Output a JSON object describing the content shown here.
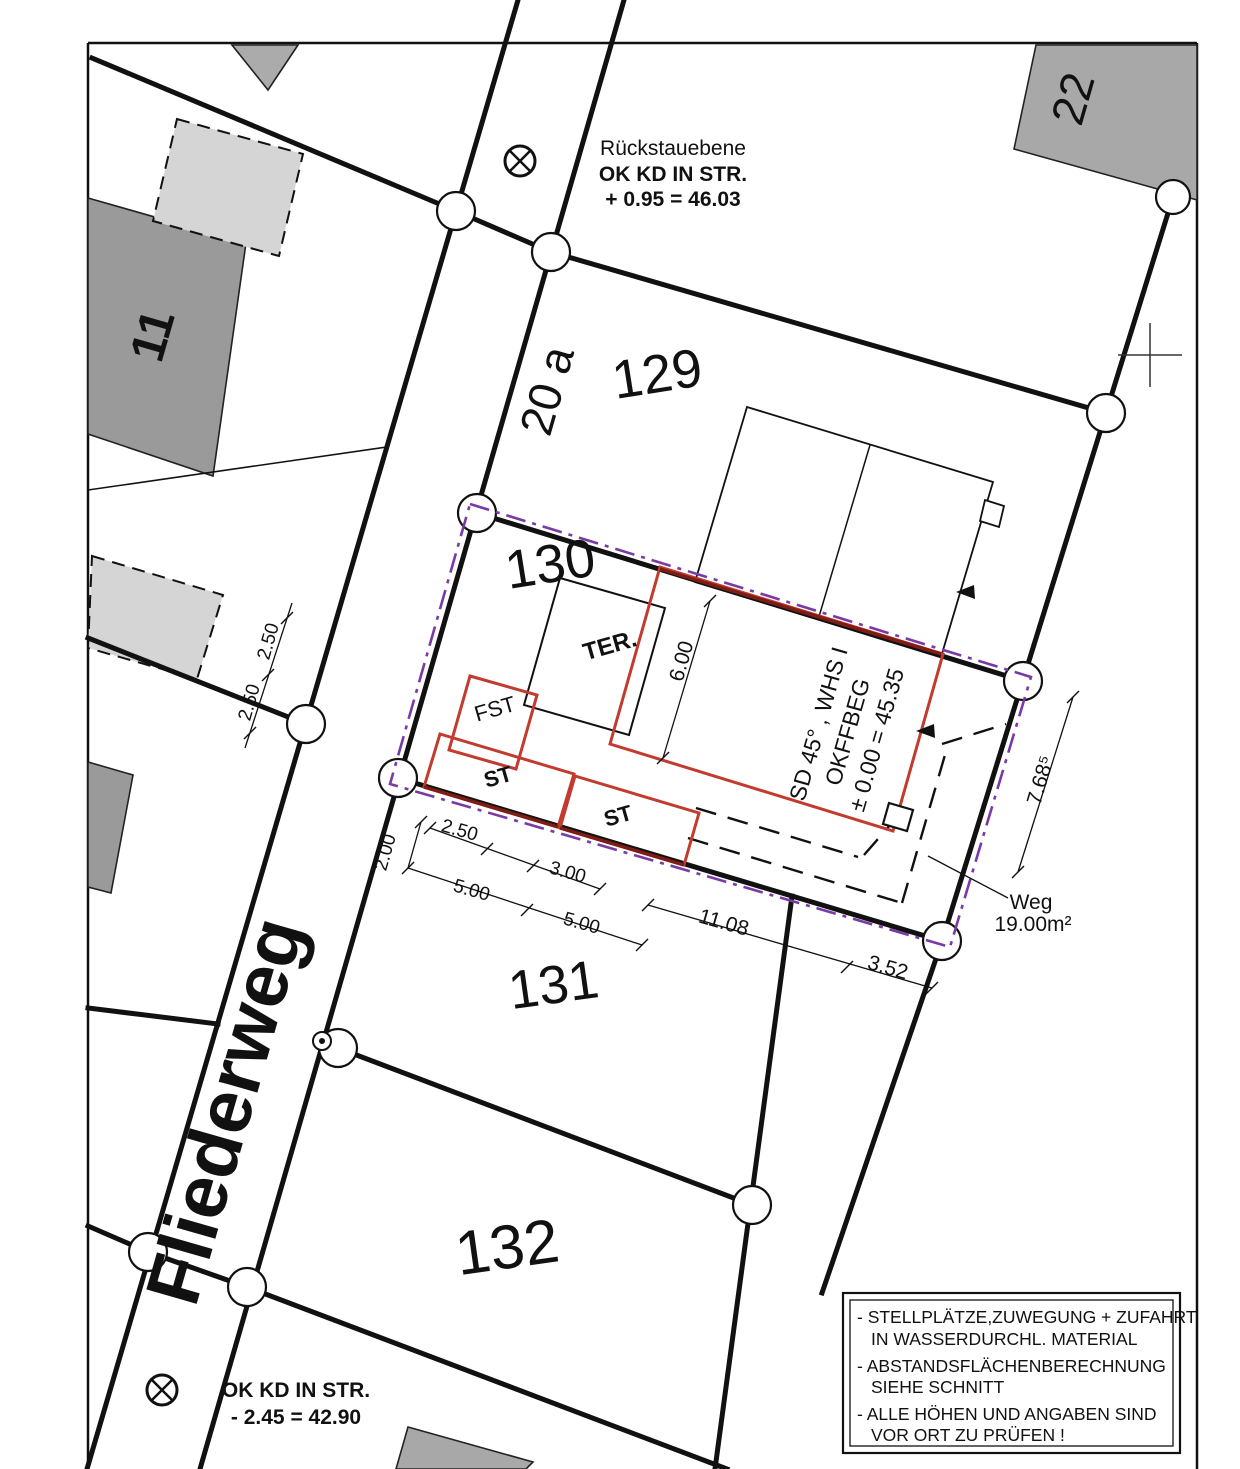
{
  "street": {
    "name": "Fliederweg"
  },
  "parcels": {
    "p11": "11",
    "p20a": "20 a",
    "p22": "22",
    "p129": "129",
    "p130": "130",
    "p131": "131",
    "p132": "132"
  },
  "levels": {
    "backflow_title": "Rückstauebene",
    "backflow_l1": "OK KD IN STR.",
    "backflow_l2": "+ 0.95 = 46.03",
    "street_l1": "OK KD IN STR.",
    "street_l2": "- 2.45 = 42.90"
  },
  "building": {
    "spec_l1": "SD 45° , WHS I",
    "spec_l2": "OKFFBEG",
    "spec_l3": "± 0.00 = 45.35",
    "terrace": "TER.",
    "fst": "FST",
    "st1": "ST",
    "st2": "ST"
  },
  "path": {
    "label": "Weg",
    "area": "19.00m²"
  },
  "dims": {
    "height": "6.00",
    "east": "7.68⁵",
    "w1": "2.50",
    "w2": "2.50",
    "v200": "2.00",
    "c250": "2.50",
    "c300": "3.00",
    "c500a": "5.00",
    "c500b": "5.00",
    "c1108": "11.08",
    "c352": "3.52"
  },
  "notes": [
    "- STELLPLÄTZE,ZUWEGUNG + ZUFAHRT",
    "IN WASSERDURCHL. MATERIAL",
    "- ABSTANDSFLÄCHENBERECHNUNG",
    "SIEHE SCHNITT",
    "- ALLE HÖHEN UND ANGABEN SIND",
    "VOR ORT ZU PRÜFEN !"
  ],
  "colors": {
    "boundary_purple": "#7a3aa5",
    "new_building_red": "#c23b2e",
    "overlap_dark_red": "#7d1d15",
    "existing_building_gray": "#9a9a9a",
    "planned_building_gray": "#d5d5d5"
  }
}
